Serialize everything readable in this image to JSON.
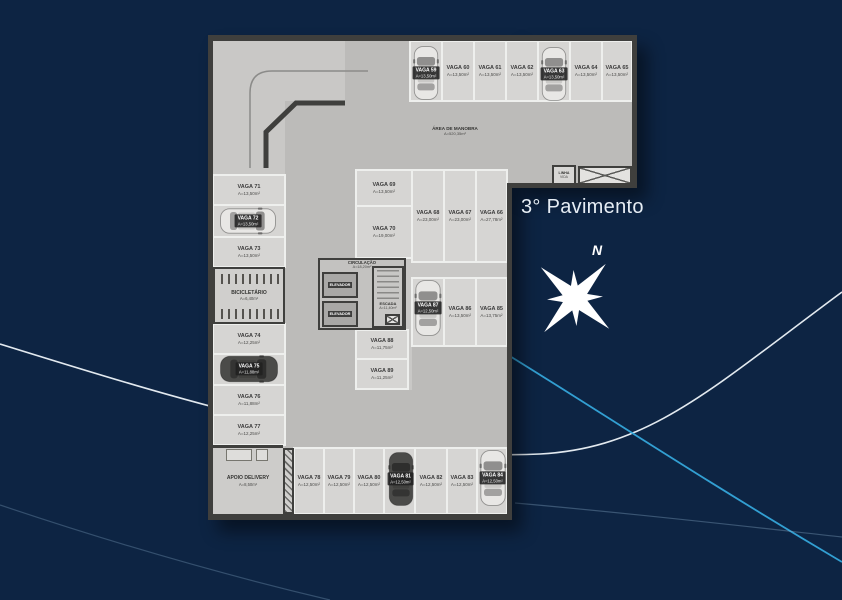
{
  "title": "3° Pavimento",
  "compass_label": "N",
  "colors": {
    "background_navy": "#0d2443",
    "accent_cyan": "#35a7da",
    "floor_gray": "#c9c8c6",
    "wall_dark": "#3f3f3d"
  },
  "plan": {
    "labels": {
      "manobra": {
        "l1": "ÁREA DE MANOBRA",
        "l2": "A=520,35m²"
      },
      "circulacao": {
        "l1": "CIRCULAÇÃO",
        "l2": "A=18,20m²"
      },
      "escada": {
        "l1": "ESCADA",
        "l2": "A=11,40m²"
      },
      "elevador1": "ELEVADOR",
      "elevador2": "ELEVADOR",
      "bicicletario": {
        "l1": "BICICLETÁRIO",
        "l2": "A=6,40m²"
      },
      "apoio": {
        "l1": "APOIO DELIVERY",
        "l2": "A=8,50m²"
      },
      "linha_vida": {
        "l1": "LINHA",
        "l2": "VIDA"
      }
    },
    "spots": [
      {
        "n": "VAGA 59",
        "a": "A=13,50m²"
      },
      {
        "n": "VAGA 60",
        "a": "A=13,50m²"
      },
      {
        "n": "VAGA 61",
        "a": "A=13,50m²"
      },
      {
        "n": "VAGA 62",
        "a": "A=13,50m²"
      },
      {
        "n": "VAGA 63",
        "a": "A=13,50m²"
      },
      {
        "n": "VAGA 64",
        "a": "A=13,50m²"
      },
      {
        "n": "VAGA 65",
        "a": "A=13,50m²"
      },
      {
        "n": "VAGA 66",
        "a": "A=27,78m²"
      },
      {
        "n": "VAGA 67",
        "a": "A=23,00m²"
      },
      {
        "n": "VAGA 68",
        "a": "A=23,00m²"
      },
      {
        "n": "VAGA 69",
        "a": "A=13,50m²"
      },
      {
        "n": "VAGA 70",
        "a": "A=19,00m²"
      },
      {
        "n": "VAGA 71",
        "a": "A=13,50m²"
      },
      {
        "n": "VAGA 72",
        "a": "A=13,50m²"
      },
      {
        "n": "VAGA 73",
        "a": "A=13,50m²"
      },
      {
        "n": "VAGA 74",
        "a": "A=12,25m²"
      },
      {
        "n": "VAGA 75",
        "a": "A=11,88m²"
      },
      {
        "n": "VAGA 76",
        "a": "A=11,88m²"
      },
      {
        "n": "VAGA 77",
        "a": "A=12,25m²"
      },
      {
        "n": "VAGA 78",
        "a": "A=12,50m²"
      },
      {
        "n": "VAGA 79",
        "a": "A=12,50m²"
      },
      {
        "n": "VAGA 80",
        "a": "A=12,50m²"
      },
      {
        "n": "VAGA 81",
        "a": "A=12,50m²"
      },
      {
        "n": "VAGA 82",
        "a": "A=12,50m²"
      },
      {
        "n": "VAGA 83",
        "a": "A=12,50m²"
      },
      {
        "n": "VAGA 84",
        "a": "A=12,50m²"
      },
      {
        "n": "VAGA 85",
        "a": "A=13,75m²"
      },
      {
        "n": "VAGA 86",
        "a": "A=13,50m²"
      },
      {
        "n": "VAGA 87",
        "a": "A=12,50m²"
      },
      {
        "n": "VAGA 88",
        "a": "A=11,75m²"
      },
      {
        "n": "VAGA 89",
        "a": "A=11,25m²"
      }
    ]
  }
}
